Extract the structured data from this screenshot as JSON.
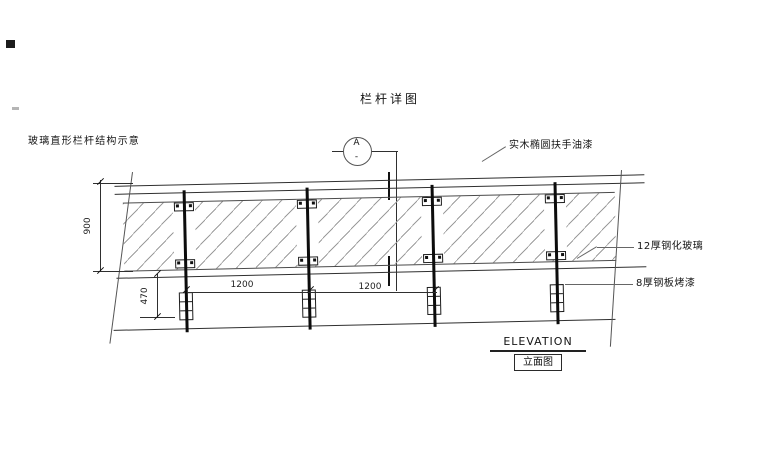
{
  "title": "栏杆详图",
  "notes": {
    "left_note": "玻璃直形栏杆结构示意"
  },
  "section_marker": {
    "letter": "A",
    "sub": "-"
  },
  "callouts": {
    "handrail": "实木椭圆扶手油漆",
    "glass": "12厚钢化玻璃",
    "post": "8厚钢板烤漆"
  },
  "dimensions": {
    "height": "900",
    "base_height": "470",
    "bay1": "1200",
    "bay2": "1200"
  },
  "footer": {
    "en": "ELEVATION",
    "cn": "立面图"
  },
  "colors": {
    "line": "#2f2f2f",
    "hatch": "#9c9c9c",
    "background": "#ffffff"
  }
}
